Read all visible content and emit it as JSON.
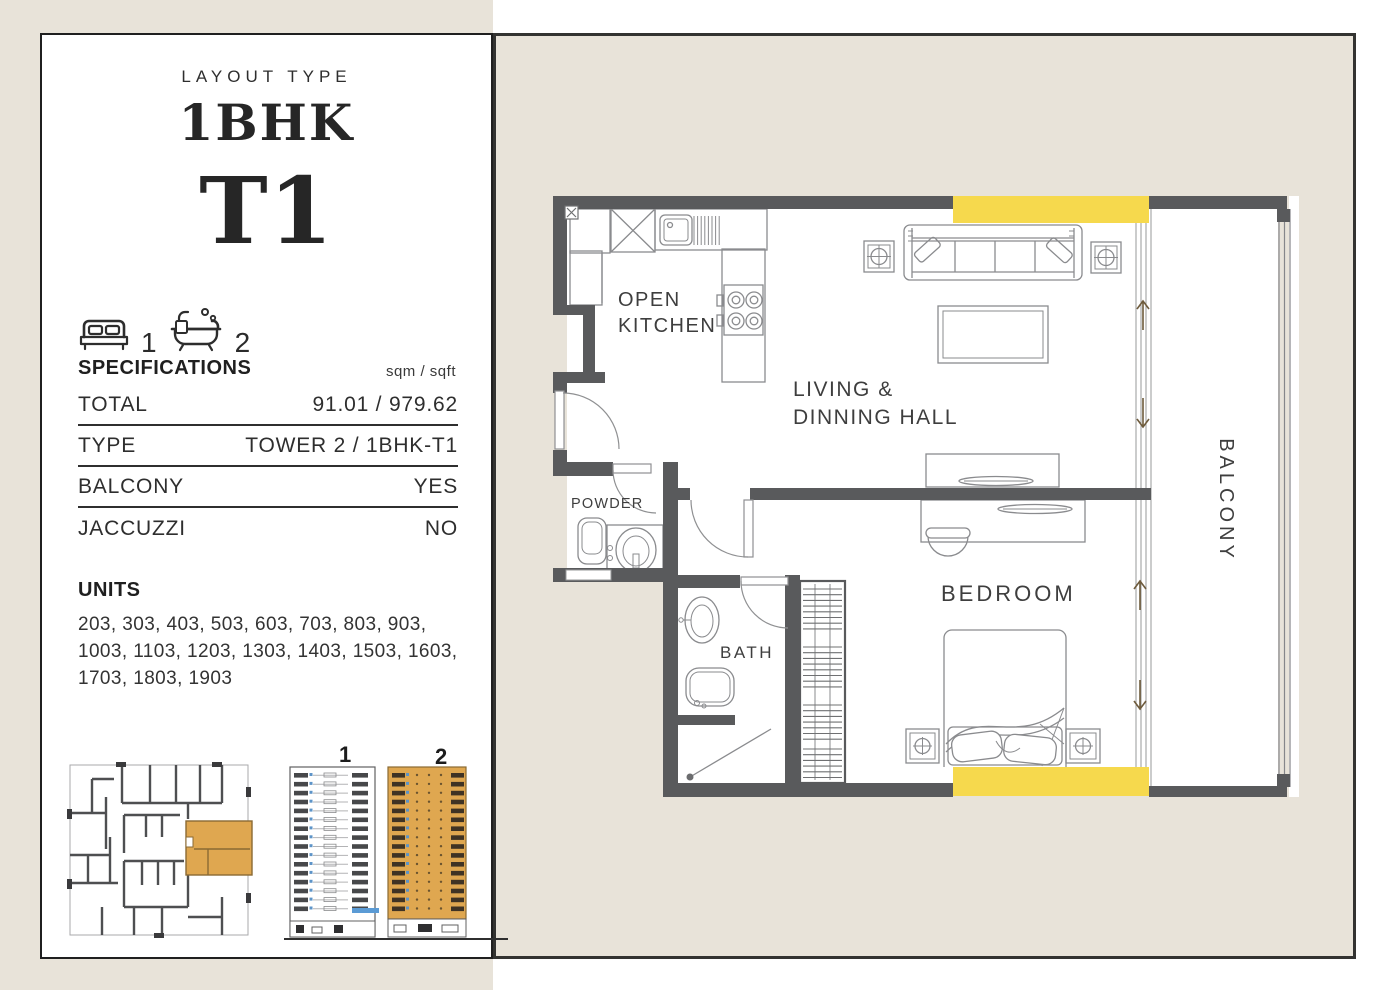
{
  "colors": {
    "background": "#ffffff",
    "panel_beige": "#e8e3d9",
    "wall_gray": "#595a5c",
    "highlight_yellow": "#f6d94d",
    "unit_tan": "#dfa750",
    "ink": "#262626"
  },
  "card": {
    "layout_type_label": "LAYOUT TYPE",
    "title": "1BHK",
    "subtitle": "T1",
    "amenities": {
      "beds": "1",
      "baths": "2"
    },
    "specifications": {
      "heading": "SPECIFICATIONS",
      "unit_note": "sqm / sqft",
      "rows": [
        {
          "label": "TOTAL",
          "value": "91.01 / 979.62"
        },
        {
          "label": "TYPE",
          "value": "TOWER 2 / 1BHK-T1"
        },
        {
          "label": "BALCONY",
          "value": "YES"
        },
        {
          "label": "JACCUZZI",
          "value": "NO"
        }
      ]
    },
    "units": {
      "heading": "UNITS",
      "lines": [
        "203, 303, 403, 503, 603, 703, 803, 903,",
        "1003, 1103, 1203, 1303, 1403, 1503, 1603,",
        "1703, 1803, 1903"
      ]
    },
    "towers": {
      "tower1_label": "1",
      "tower2_label": "2"
    }
  },
  "floorplan": {
    "labels": {
      "kitchen_line1": "OPEN",
      "kitchen_line2": "KITCHEN",
      "living_line1": "LIVING &",
      "living_line2": "DINNING HALL",
      "powder": "POWDER",
      "bath": "BATH",
      "bedroom": "BEDROOM",
      "balcony": "BALCONY"
    }
  }
}
